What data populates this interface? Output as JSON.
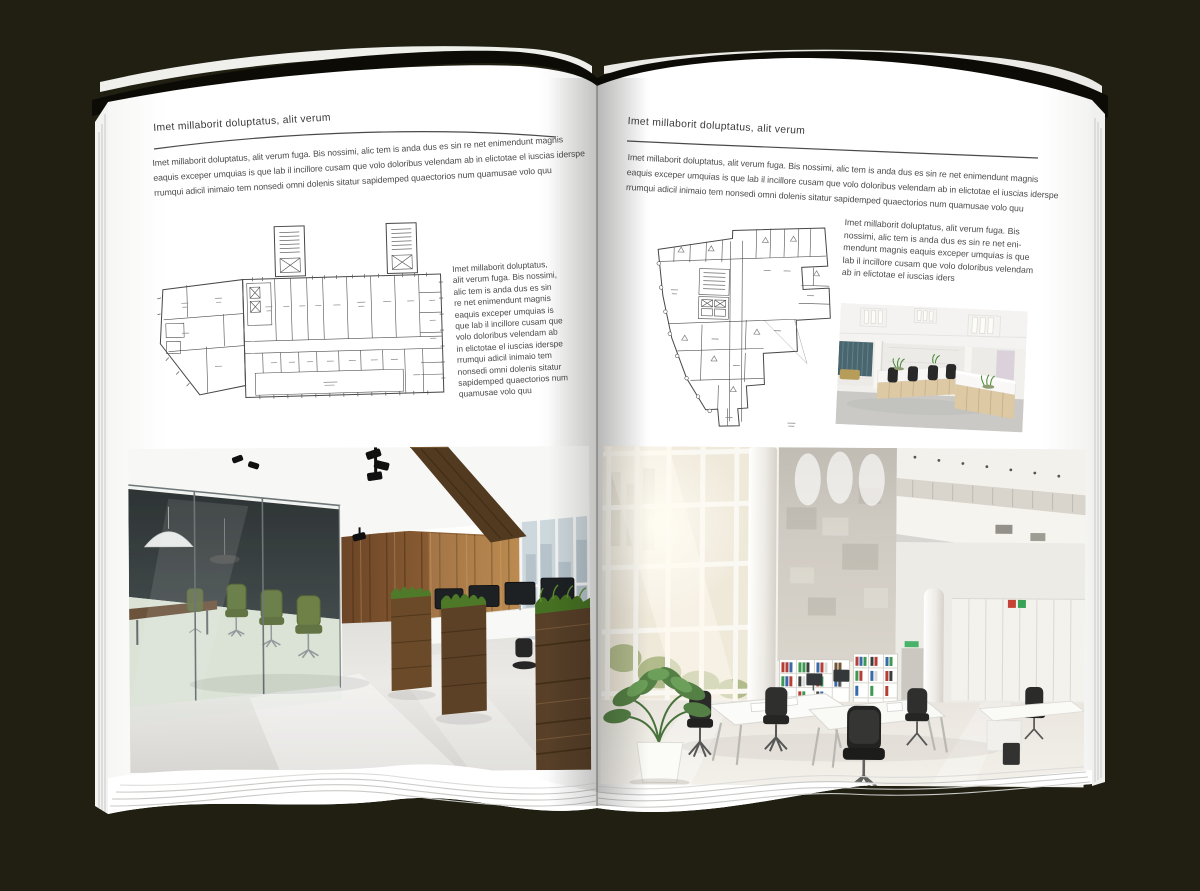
{
  "background": {
    "color": "#201f12"
  },
  "book": {
    "page_color": "#ffffff",
    "cover_color": "#0c0b06"
  },
  "left_page": {
    "header": "Imet millaborit doluptatus, alit verum",
    "intro_lines": [
      "Imet millaborit doluptatus, alit verum fuga. Bis nossimi, alic tem is anda dus es sin re net enimendunt magnis",
      "eaquis exceper umquias is que lab il incillore cusam que volo doloribus velendam ab in elictotae el iuscias iderspe",
      "rrumqui adicil inimaio tem nonsedi omni dolenis sitatur sapidemped quaectorios num quamusae volo quu"
    ],
    "side_lines": [
      "Imet millaborit doluptatus,",
      "alit verum fuga. Bis nossimi,",
      "alic tem is anda dus es sin",
      "re net enimendunt magnis",
      "eaquis exceper umquias is",
      "que lab il incillore cusam que",
      "volo doloribus velendam ab",
      "in elictotae el iuscias iderspe",
      "rrumqui adicil inimaio tem",
      "nonsedi omni dolenis sitatur",
      "sapidemped quaectorios num",
      "quamusae volo quu"
    ]
  },
  "right_page": {
    "header": "Imet millaborit doluptatus, alit verum",
    "intro_lines": [
      "Imet millaborit doluptatus, alit verum fuga. Bis nossimi, alic tem is anda dus es sin re net enimendunt magnis",
      "eaquis exceper umquias is que lab il incillore cusam que volo doloribus velendam ab in elictotae el iuscias iderspe",
      "rrumqui adicil inimaio tem nonsedi omni dolenis sitatur sapidemped quaectorios num quamusae volo quu"
    ],
    "side_lines": [
      "Imet millaborit doluptatus, alit verum fuga. Bis",
      "nossimi, alic tem is anda dus es sin re net eni-",
      "mendunt magnis eaquis exceper umquias is que",
      "lab il incillore cusam que volo doloribus velendam",
      "ab in elictotae el iuscias iders"
    ]
  }
}
